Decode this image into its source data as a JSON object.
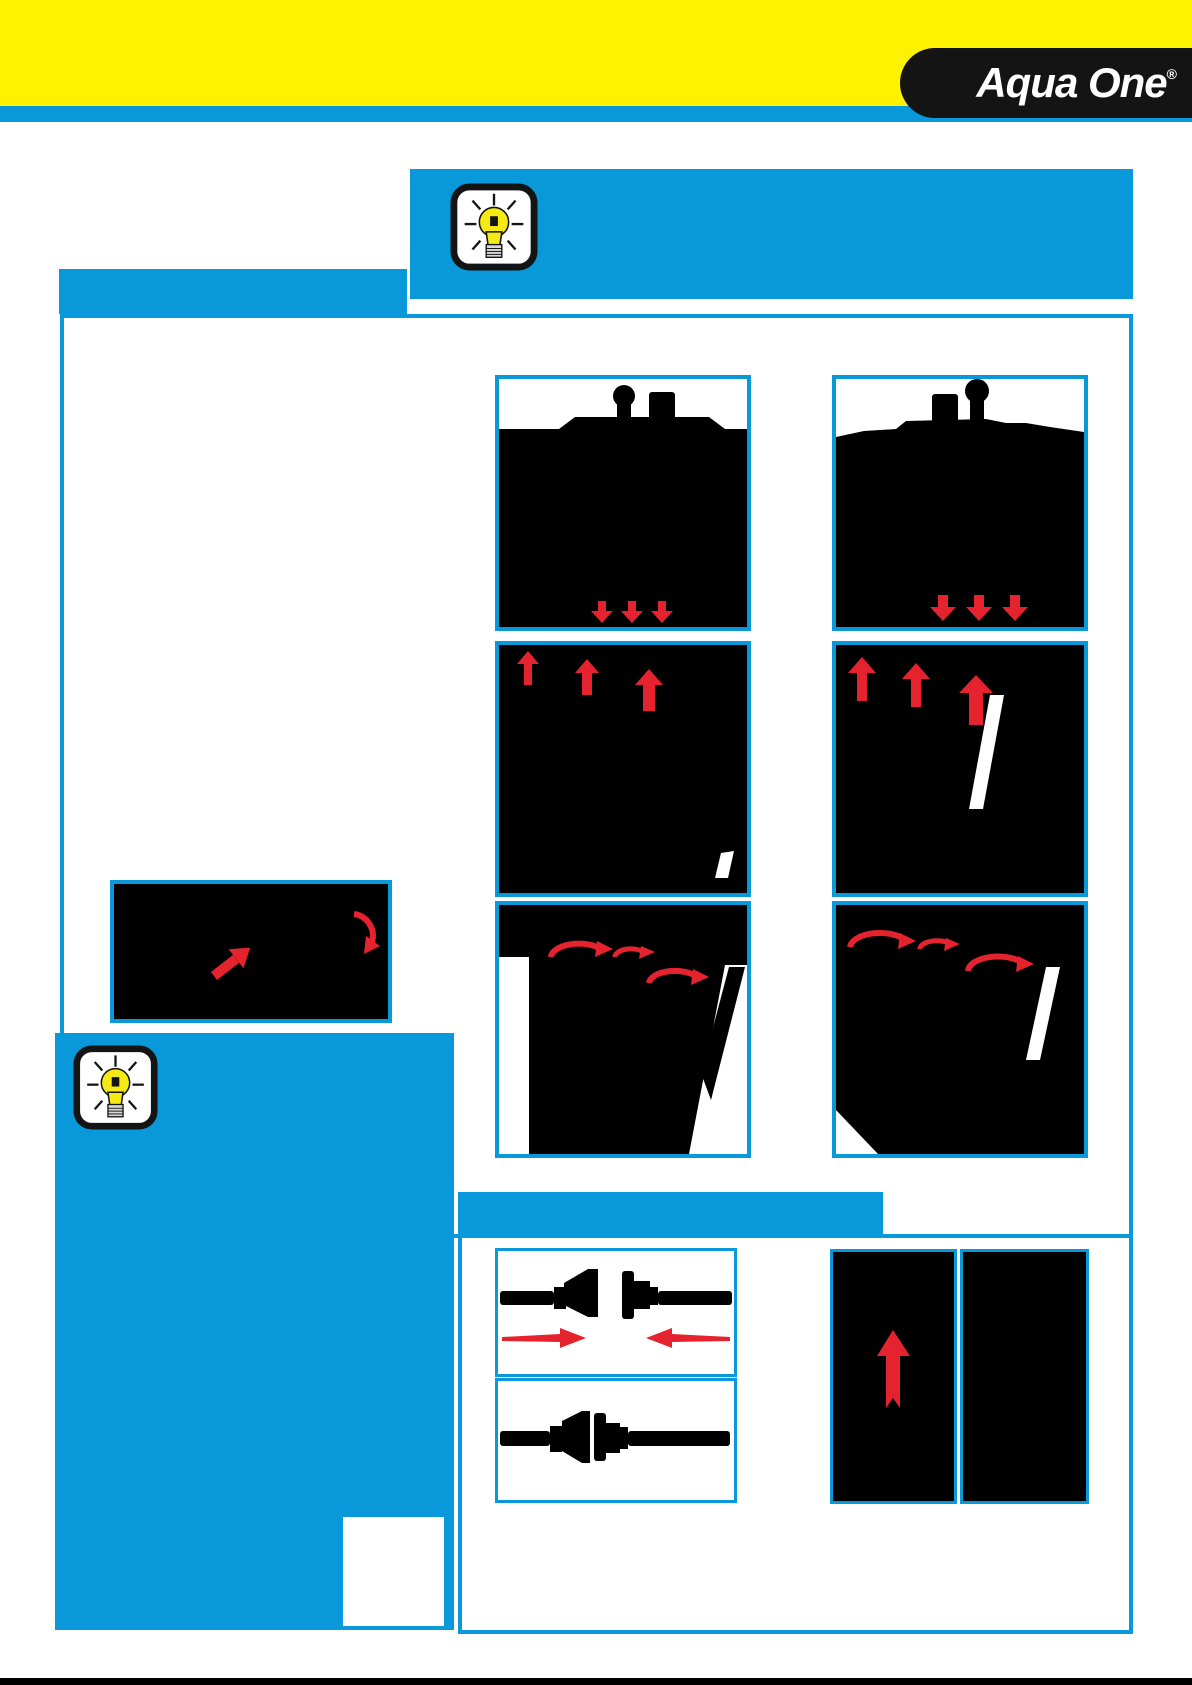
{
  "brand": {
    "logo_text": "Aqua One",
    "registered_mark": "®"
  },
  "colors": {
    "brand_yellow": "#FFF200",
    "brand_blue": "#0999DA",
    "arrow_red": "#E5232E",
    "silhouette_black": "#000000",
    "logo_plate_black": "#141414"
  },
  "icons": {
    "top_tip": "lightbulb-icon",
    "side_tip": "lightbulb-icon",
    "diagram_arrows": [
      "red-down-arrow",
      "red-up-arrow",
      "red-curved-arrow",
      "red-horizontal-arrow"
    ]
  }
}
